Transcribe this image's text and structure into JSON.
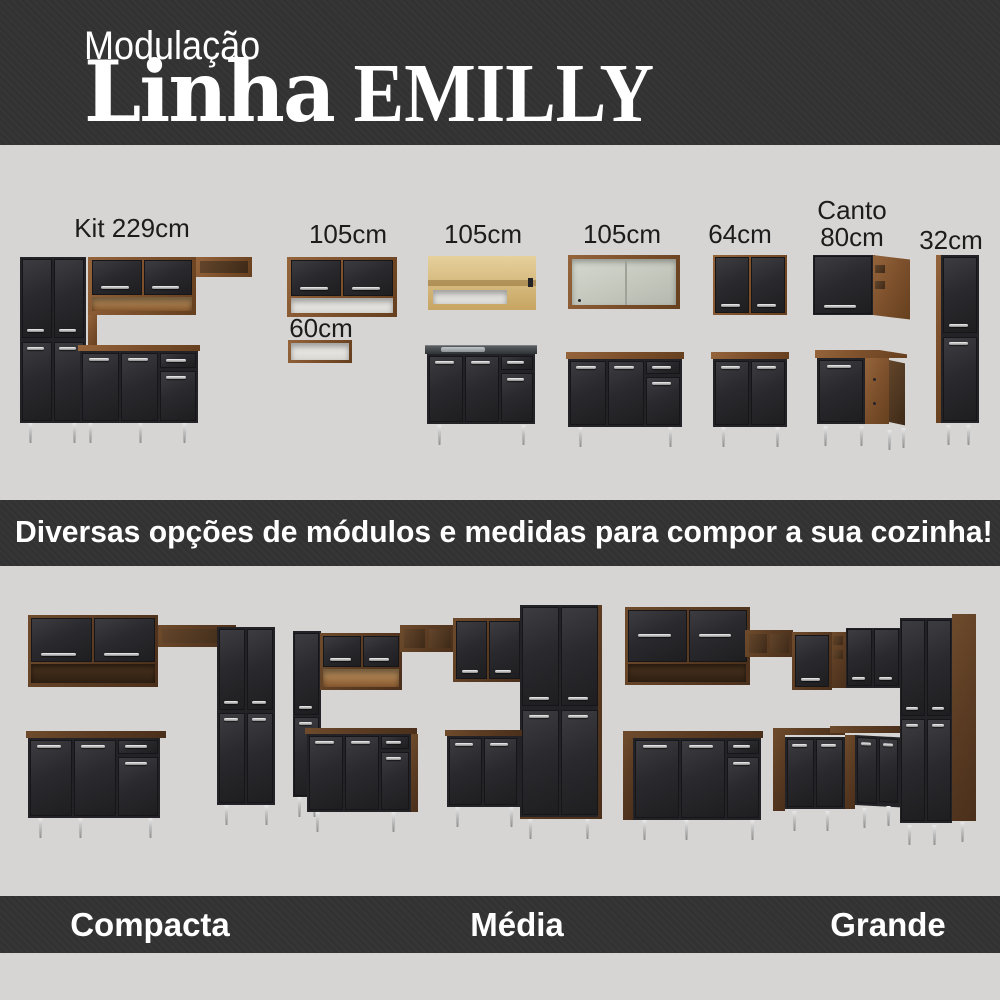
{
  "header": {
    "kicker": "Modulação",
    "title_primary": "Linha",
    "title_secondary": "EMILLY"
  },
  "modules": [
    {
      "label": "Kit 229cm"
    },
    {
      "label": "105cm"
    },
    {
      "label": "60cm"
    },
    {
      "label": "105cm"
    },
    {
      "label": "105cm"
    },
    {
      "label": "64cm"
    },
    {
      "label": "Canto",
      "label2": "80cm"
    },
    {
      "label": "32cm"
    }
  ],
  "banner": {
    "text": "Diversas opções de módulos e medidas para compor a sua cozinha!"
  },
  "kitchens": [
    {
      "label": "Compacta"
    },
    {
      "label": "Média"
    },
    {
      "label": "Grande"
    }
  ],
  "colors": {
    "band_background": "#333233",
    "page_background": "#d6d5d3",
    "door_black": "#2b2b2e",
    "wood_brown": "#7a4e2a",
    "wood_dark": "#4d3520",
    "handle_silver": "#c9c9c9",
    "text_dark": "#1c1c1c",
    "text_light": "#ffffff"
  }
}
